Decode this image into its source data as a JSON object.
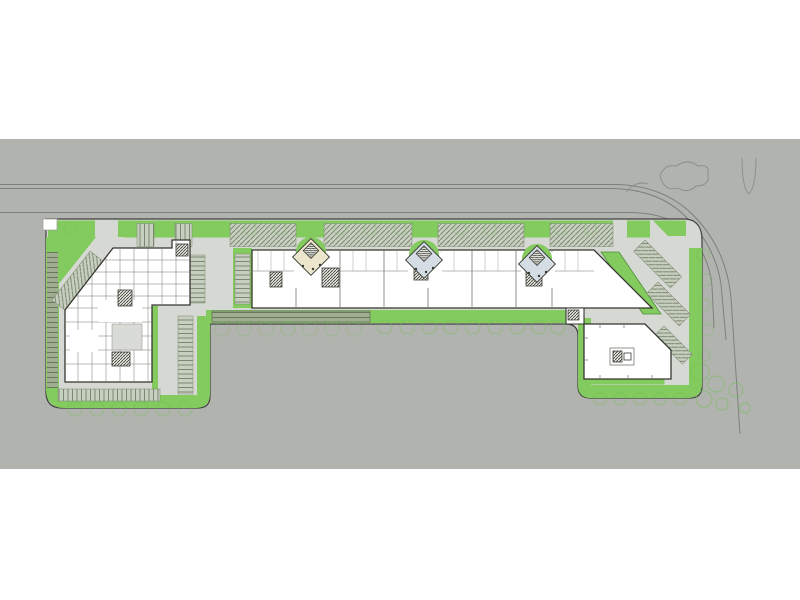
{
  "meta": {
    "kind": "architectural-site-plan",
    "description": "Ground floor site plan rendering: L-shaped commercial development with three building masses, diamond entry pavilions, perimeter landscaping and surface parking along a curving road",
    "visible_text": []
  },
  "palette": {
    "canvas_bg": "#ffffff",
    "context_ground": "#b1b3ae",
    "road_line": "#7d807b",
    "site_pavement": "#d6d8d3",
    "site_outline": "#3f403b",
    "green": "#83ca5f",
    "green_outline": "#4f8f3a",
    "hedge": "#9fae90",
    "hedge_line": "#5c6b50",
    "stall_bg": "#c7cfc0",
    "stall_line": "#7d8871",
    "building_fill": "#ffffff",
    "building_outline": "#35352f",
    "partition_line": "#76766f",
    "core_hatch": "#3a3a35",
    "pavilion_cream": "#ece7cc",
    "pavilion_blue": "#d4dde4",
    "walkway": "#e9eae6",
    "courtyard_fill": "#d9dbd6",
    "tree": "#6fbf4f",
    "tree_gray": "#8a8d87"
  },
  "scene": {
    "context": {
      "band_top_px": 139,
      "band_bottom_px": 469
    },
    "road": {
      "orientation": "horizontal, curving down at right",
      "lines": 3
    },
    "site": {
      "shape": "long bar with two south lobes",
      "outline_color": "#3f403b"
    },
    "buildings": [
      {
        "id": "west-building",
        "form": "deep plan with many small rooms, 45-degree cut at northwest corner"
      },
      {
        "id": "linear-building",
        "form": "long east-west bar with three unit entries, diagonal cut at east end"
      },
      {
        "id": "southeast-building",
        "form": "open-plan hall with diagonal northeast edge and small core room"
      }
    ],
    "entry_pavilions": {
      "count": 3,
      "shape": "rotated-square kiosks with stair cores",
      "fills": [
        "#ece7cc",
        "#d4dde4",
        "#d4dde4"
      ]
    },
    "parking": {
      "patterns": [
        "herringbone rows along north edge",
        "stall columns in west court",
        "diagonal rows at east edge",
        "row at southwest lobe"
      ]
    },
    "landscaping": {
      "features": [
        "perimeter green borders",
        "hedge strips",
        "green parallelogram island",
        "tree rows",
        "tree cluster at southeast"
      ]
    }
  }
}
